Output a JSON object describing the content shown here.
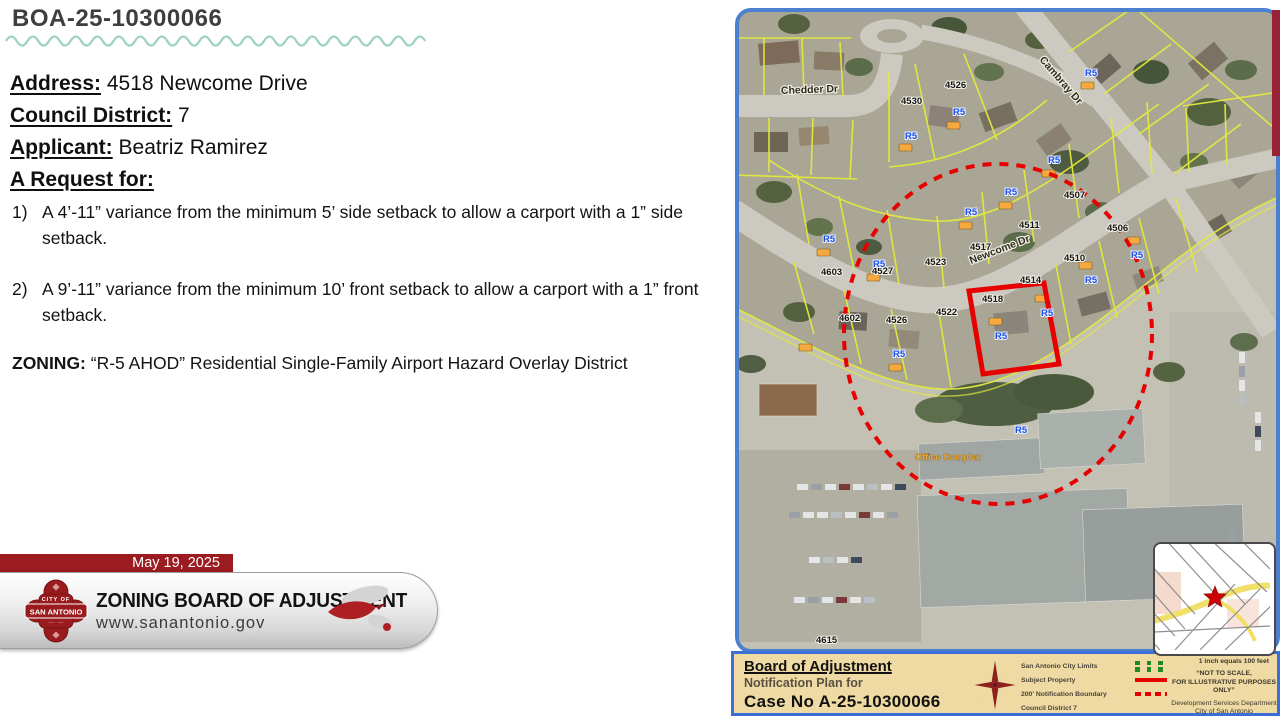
{
  "slide": {
    "title": "BOA-25-10300066",
    "fields": [
      {
        "label": "Address:",
        "value": "4518 Newcome Drive"
      },
      {
        "label": "Council District:",
        "value": "7"
      },
      {
        "label": "Applicant:",
        "value": "Beatriz Ramirez"
      }
    ],
    "request_heading": "A Request for:",
    "requests": [
      {
        "num": "1)",
        "text": "A 4’-11” variance from the minimum 5’ side setback to allow a carport with a 1” side setback."
      },
      {
        "num": "2)",
        "text": "A 9’-11” variance from the minimum 10’ front setback to allow a carport with a 1” front setback."
      }
    ],
    "zoning_label": "ZONING:",
    "zoning_text": " “R-5 AHOD” Residential Single-Family Airport Hazard Overlay District"
  },
  "footer": {
    "date": "May 19, 2025",
    "board_name": "ZONING BOARD OF ADJUSTMENT",
    "website": "www.sanantonio.gov",
    "logo": {
      "top": "CITY OF",
      "name": "SAN ANTONIO"
    }
  },
  "map": {
    "streets": {
      "chedder": "Chedder Dr",
      "cambray": "Cambray Dr",
      "newcome": "Newcome Dr"
    },
    "zone_label": "R5",
    "office_label": "Office Complex",
    "parcels": {
      "p4530": "4530",
      "p4526_top": "4526",
      "p4507": "4507",
      "p4511": "4511",
      "p4517": "4517",
      "p4523": "4523",
      "p4527": "4527",
      "p4603": "4603",
      "p4602": "4602",
      "p4526": "4526",
      "p4522": "4522",
      "p4518": "4518",
      "p4514": "4514",
      "p4510": "4510",
      "p4506": "4506",
      "p4615": "4615"
    }
  },
  "legend": {
    "heading": "Board of Adjustment",
    "subheading": "Notification Plan for",
    "case_line": "Case No A-25-10300066",
    "items": [
      {
        "label": "San Antonio City Limits"
      },
      {
        "label": "Subject Property"
      },
      {
        "label": "200' Notification Boundary"
      },
      {
        "label": "Council District 7"
      }
    ],
    "scale_note": "1 inch equals 100 feet",
    "disclaimer_1": "“NOT TO SCALE,",
    "disclaimer_2": "FOR ILLUSTRATIVE PURPOSES ONLY”",
    "dept_1": "Development Services Department",
    "dept_2": "City of San Antonio"
  }
}
